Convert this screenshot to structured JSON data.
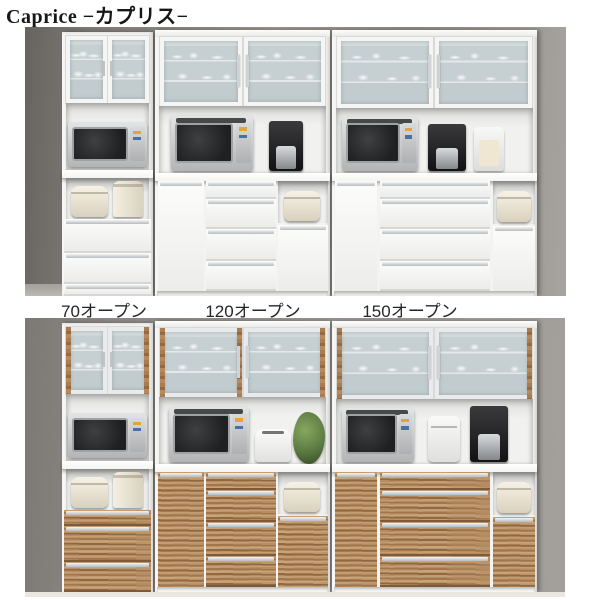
{
  "title": "Caprice −カプリス−",
  "variants": [
    {
      "label": "70オープン"
    },
    {
      "label": "120オープン"
    },
    {
      "label": "150オープン"
    }
  ],
  "photos": {
    "top": {
      "finish": "white",
      "appliances": [
        "microwave",
        "microwave oven",
        "coffee maker",
        "rice cooker",
        "electric pot",
        "food processor"
      ]
    },
    "bottom": {
      "finish": "walnut brown",
      "appliances": [
        "microwave",
        "microwave oven",
        "toaster",
        "plant",
        "bread maker",
        "coffee maker",
        "rice cooker",
        "electric pot"
      ]
    }
  },
  "colors": {
    "background": "#ffffff",
    "cabinet_white": "#f3f3f1",
    "wood_brown": "#aa7e54",
    "frosted_glass": "#c7d1d3",
    "wall_gray": "#94908c",
    "title_text": "#171717",
    "label_text": "#262626"
  }
}
